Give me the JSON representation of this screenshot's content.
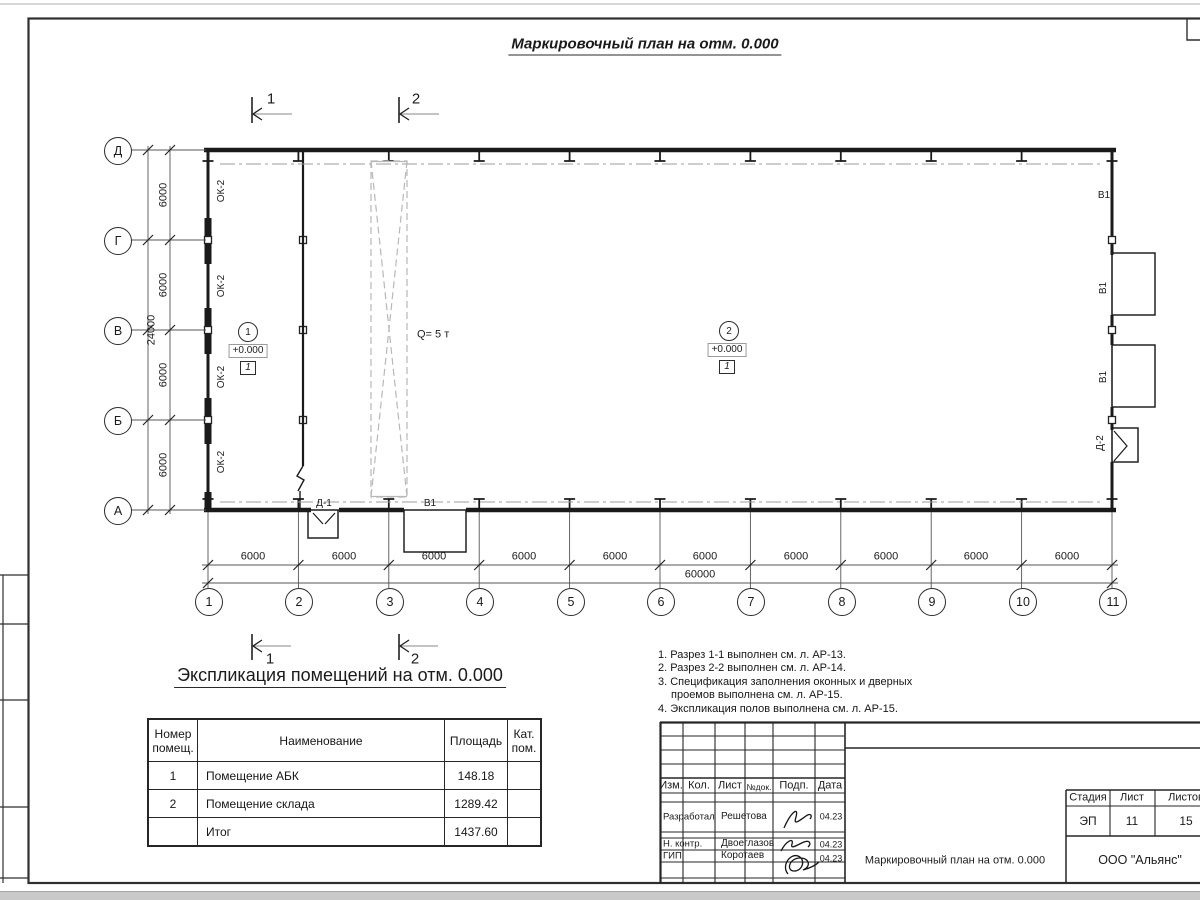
{
  "plan_title": "Маркировочный план на отм. 0.000",
  "spec_heading": "Экспликация помещений на отм. 0.000",
  "axes": {
    "rows": [
      "Д",
      "Г",
      "В",
      "Б",
      "А"
    ],
    "cols": [
      "1",
      "2",
      "3",
      "4",
      "5",
      "6",
      "7",
      "8",
      "9",
      "10",
      "11"
    ]
  },
  "dims": {
    "bay_h": "6000",
    "bay_v": "6000",
    "total_h": "60000",
    "total_v": "24000"
  },
  "sections": {
    "s1": "1",
    "s2": "2"
  },
  "labels": {
    "window": "ОК-2",
    "gate": "В1",
    "door1": "Д-1",
    "door2": "Д-2",
    "crane": "Q= 5 т"
  },
  "rooms": {
    "r1": {
      "num": "1",
      "elev": "+0.000",
      "floor": "1"
    },
    "r2": {
      "num": "2",
      "elev": "+0.000",
      "floor": "1"
    }
  },
  "notes": {
    "line1": "1. Разрез 1-1 выполнен см. л. АР-13.",
    "line2": "2. Разрез 2-2 выполнен см. л. АР-14.",
    "line3": "3. Спецификация заполнения оконных и дверных",
    "line4": "проемов выполнена см. л. АР-15.",
    "line5": "4. Экспликация полов выполнена см. л. АР-15."
  },
  "spec_table": {
    "headers": {
      "num": "Номер помещ.",
      "name": "Наименование",
      "area": "Площадь",
      "cat": "Кат. пом."
    },
    "rows": [
      {
        "num": "1",
        "name": "Помещение АБК",
        "area": "148.18",
        "cat": ""
      },
      {
        "num": "2",
        "name": "Помещение склада",
        "area": "1289.42",
        "cat": ""
      },
      {
        "num": "",
        "name": "Итог",
        "area": "1437.60",
        "cat": ""
      }
    ]
  },
  "titleblock": {
    "cols": {
      "izm": "Изм.",
      "kol": "Кол.",
      "list": "Лист",
      "ndok": "№док.",
      "podp": "Подп.",
      "data": "Дата"
    },
    "rows": [
      {
        "role": "Разработал",
        "name": "Решетова",
        "date": "04.23"
      },
      {
        "role": "Н. контр.",
        "name": "Двоеглазов",
        "date": "04.23"
      },
      {
        "role": "ГИП",
        "name": "Коротаев",
        "date": "04.23"
      }
    ],
    "doc_title": "Маркировочный план на отм. 0.000",
    "company": "ООО \"Альянс\"",
    "stage": {
      "h1": "Стадия",
      "h2": "Лист",
      "h3": "Листов",
      "v1": "ЭП",
      "v2": "11",
      "v3": "15"
    }
  },
  "colors": {
    "line": "#1a1a1a",
    "crane": "#b8b8b8",
    "dashdot": "#9c9c9c"
  }
}
